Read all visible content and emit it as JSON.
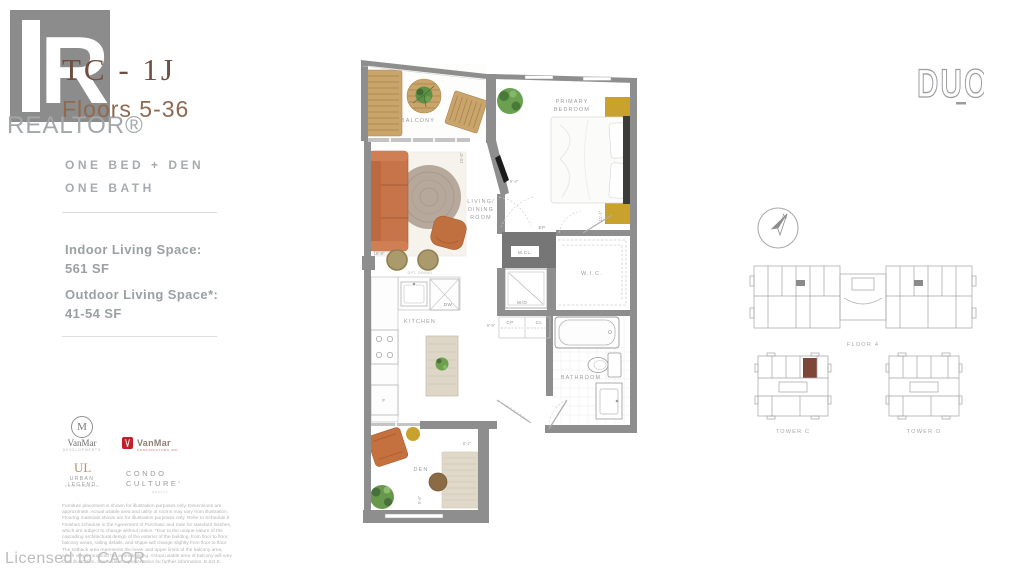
{
  "brand": {
    "realtor_word": "REALTOR®",
    "realtor_letter": "R",
    "duo": "DUO"
  },
  "header": {
    "plan_code": "TC - 1J",
    "floors": "Floors 5-36",
    "config_line1": "ONE BED + DEN",
    "config_line2": "ONE BATH",
    "indoor_label": "Indoor Living Space:",
    "indoor_value": "561 SF",
    "outdoor_label": "Outdoor Living Space*:",
    "outdoor_value": "41-54 SF"
  },
  "developers": {
    "vanmar_circle": {
      "monogram": "M",
      "name": "VanMar",
      "sub": "DEVELOPMENTS"
    },
    "vanmar_red": {
      "name": "VanMar",
      "sub": "CONSTRUCTORS INC."
    },
    "urban_legend": {
      "monogram": "UL",
      "name": "URBAN LEGEND",
      "sub": "DEVELOPMENTS"
    },
    "condo_culture": {
      "line1": "CONDO",
      "line2": "CULTURE'",
      "sub": "REALTY"
    }
  },
  "disclaimer": "Furniture placement is shown for illustration purposes only. Dimensions are approximate. Actual usable area and utility of rooms may vary from illustration. Flooring materials shown are for illustration purposes only. Refer to Schedule 6 Finishes schedule in the Agreement of Purchase and Sale for standard finishes, which are subject to change without notice. *Due to the unique nature of the cascading architectural design of the exterior of the building, from floor to floor, balcony areas, railing details, and shape will change slightly from floor to floor. The setback area represents the lower and upper limits of the balcony area, which vary throughout the entire building. Actual usable area of balcony will vary from illustration. See a sales representative for further information. E.&O.E.",
  "footer": {
    "licensed": "Licensed to CAOR"
  },
  "floorplan": {
    "rooms": {
      "balcony": "BALCONY",
      "bedroom1": "PRIMARY",
      "bedroom2": "BEDROOM",
      "living1": "LIVING/",
      "living2": "DINING",
      "living3": "ROOM",
      "kitchen": "KITCHEN",
      "wic": "W.I.C.",
      "bathroom": "BATHROOM",
      "den": "DEN"
    },
    "fixtures": {
      "mcl": "M.CL.",
      "wd": "W/D",
      "dw": "DW",
      "ep": "EP",
      "cp": "CP",
      "cl": "CL",
      "fridge": "F",
      "opt": "OPT. DINING"
    },
    "dims": {
      "living_w": "18'-9\"",
      "living_h": "15'-0\"",
      "bed_w": "9'-4\"",
      "bed_h": "11'-1\"",
      "hall": "9'-9\"",
      "den_w": "8'-2\"",
      "den_h": "5'-6\""
    }
  },
  "keyplan": {
    "compass_n": "N",
    "floor": "FLOOR 4",
    "tower_c": "TOWER C",
    "tower_d": "TOWER D"
  },
  "colors": {
    "title_brown": "#6e4f41",
    "wall_gray": "#8e8e8e",
    "highlight_unit": "#7d4639",
    "sofa_orange": "#c7744a",
    "gold": "#c9a22e",
    "wood": "#c9a56b"
  }
}
